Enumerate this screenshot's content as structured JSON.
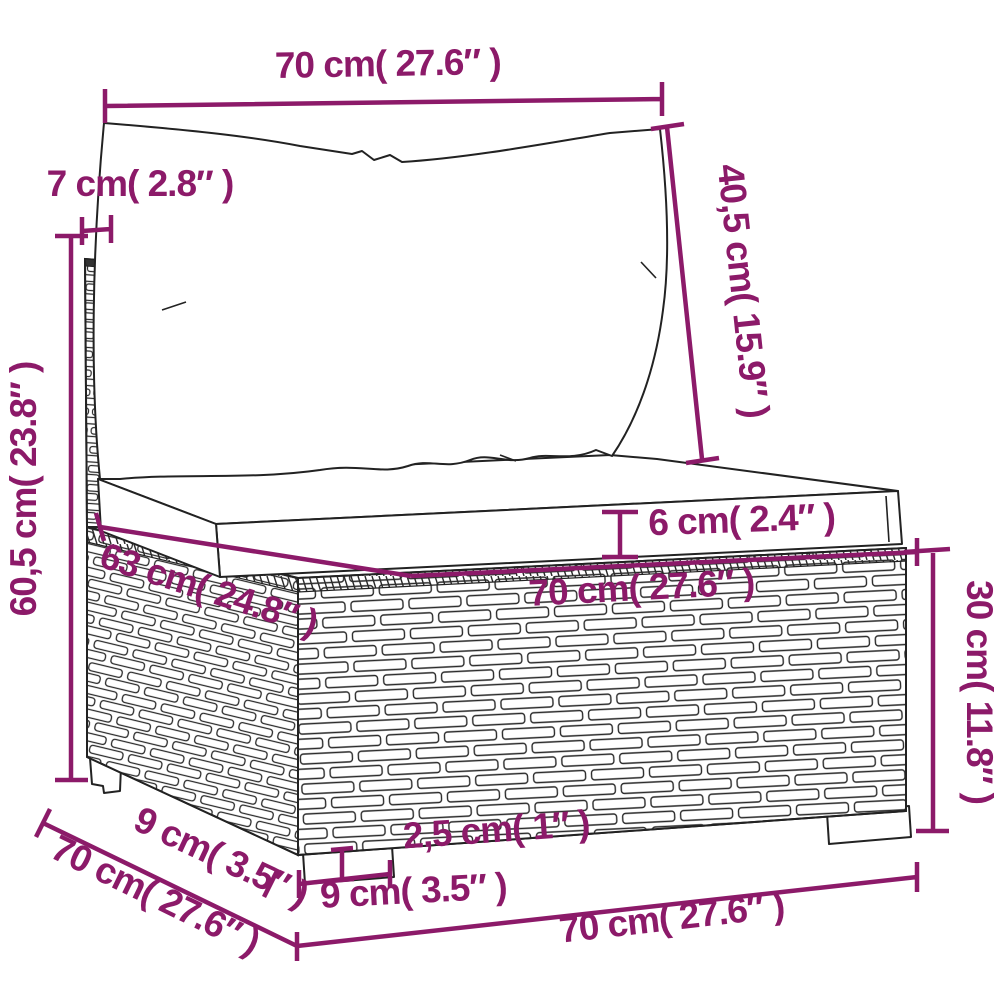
{
  "diagram": {
    "title": "Rattan sofa middle section with cushions — dimension diagram",
    "style": {
      "dimension_color": "#8C1A69",
      "outline_color": "#222222",
      "background": "#ffffff"
    },
    "dimensions": {
      "top_width": {
        "label": "70 cm( 27.6″ )"
      },
      "back_thickness": {
        "label": "7 cm( 2.8″ )"
      },
      "back_cushion_height": {
        "label": "40,5 cm( 15.9″ )"
      },
      "total_height": {
        "label": "60,5 cm( 23.8″ )"
      },
      "seat_cushion_thickness": {
        "label": "6 cm( 2.4″ )"
      },
      "seat_depth_diagonal": {
        "label": "63 cm( 24.8″ )"
      },
      "seat_width": {
        "label": "70 cm( 27.6″ )"
      },
      "base_height": {
        "label": "30 cm( 11.8″ )"
      },
      "side_depth": {
        "label": "70 cm( 27.6″ )"
      },
      "leg_depth": {
        "label": "9 cm( 3.5″ )"
      },
      "leg_height": {
        "label": "2,5 cm( 1″ )"
      },
      "leg_width": {
        "label": "9 cm( 3.5″ )"
      },
      "bottom_width": {
        "label": "70 cm( 27.6″ )"
      }
    }
  }
}
